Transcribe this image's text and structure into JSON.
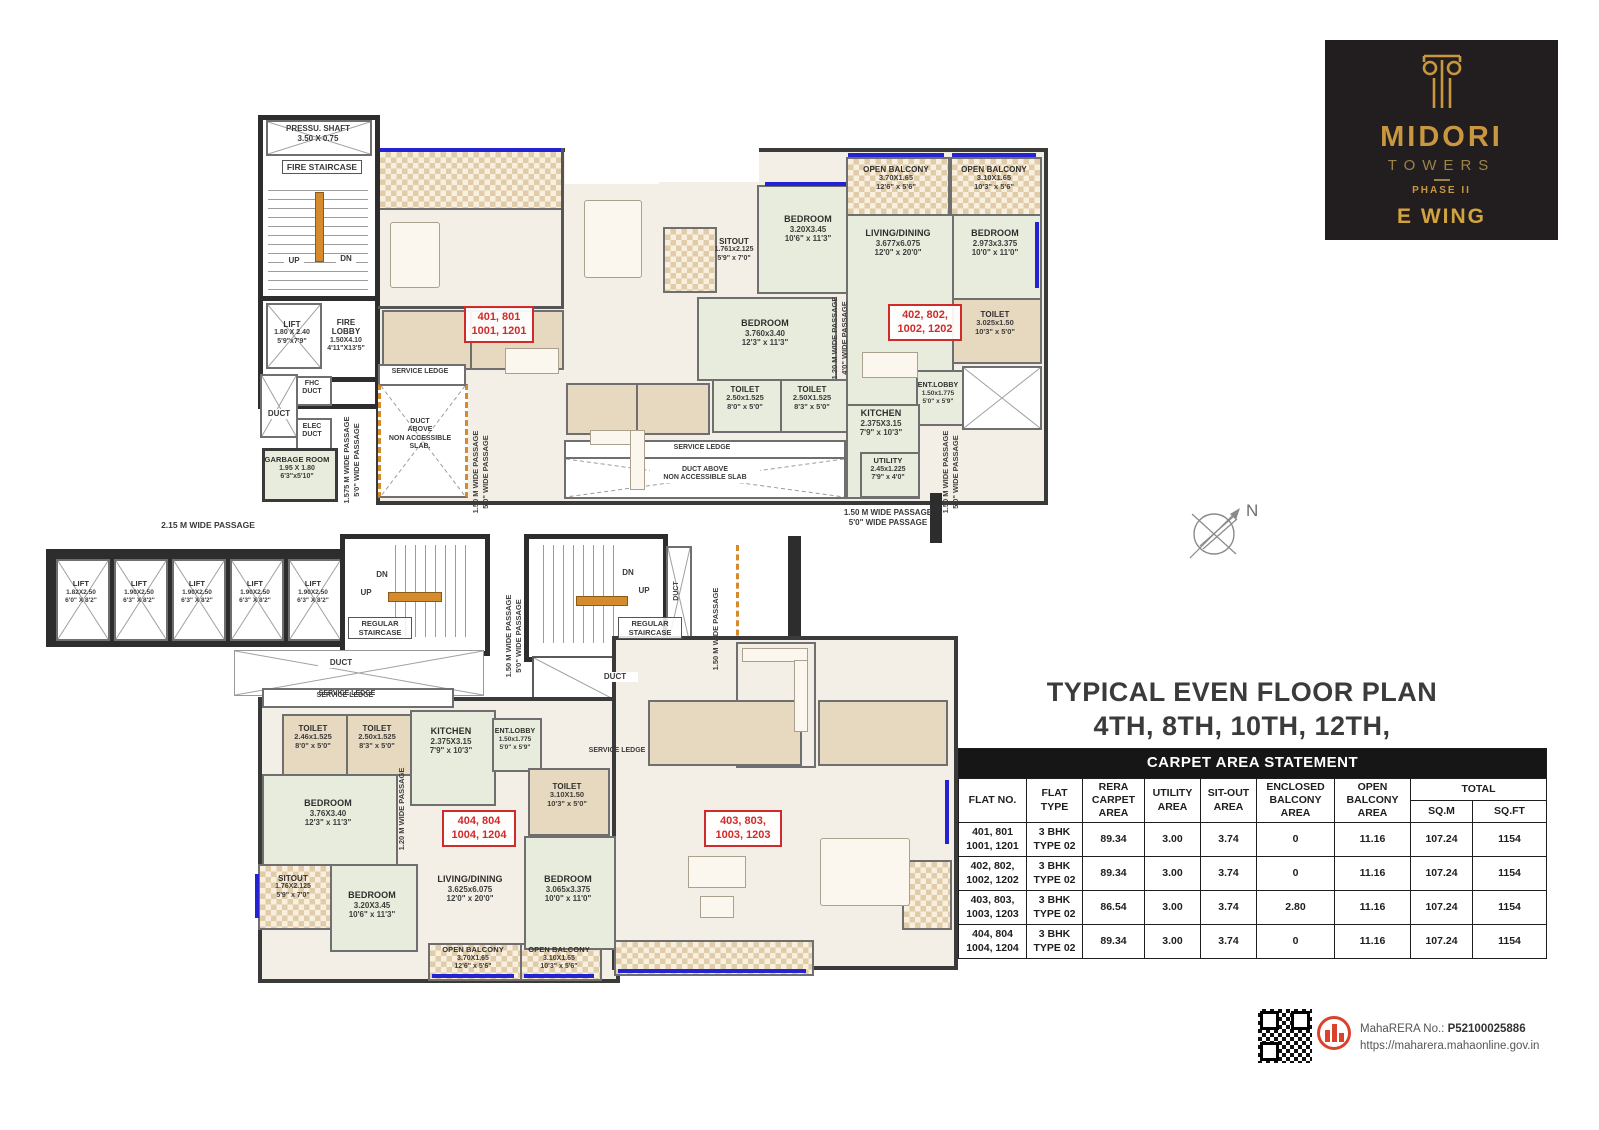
{
  "logo": {
    "brand": "MIDORI",
    "sub": "TOWERS",
    "phase": "PHASE II",
    "wing": "E WING"
  },
  "plan_title": {
    "line1": "TYPICAL EVEN FLOOR PLAN",
    "line2": "4TH, 8TH, 10TH, 12TH, FLOOR"
  },
  "compass": {
    "label": "N"
  },
  "colors": {
    "logo_gold": "#c9973f",
    "flat_number_red": "#cf2b2b",
    "rera_red": "#d9422b",
    "window_blue": "#2323d4",
    "stair_rail_orange": "#d68a2e"
  },
  "table": {
    "title": "CARPET AREA STATEMENT",
    "headers": {
      "flat_no": "FLAT NO.",
      "flat_type": "FLAT TYPE",
      "rera": "RERA CARPET AREA",
      "utility": "UTILITY AREA",
      "sitout": "SIT-OUT AREA",
      "enclosed": "ENCLOSED BALCONY AREA",
      "open": "OPEN BALCONY AREA",
      "total": "TOTAL",
      "sqm": "SQ.M",
      "sqft": "SQ.FT"
    },
    "rows": [
      {
        "no1": "401, 801",
        "no2": "1001, 1201",
        "type1": "3 BHK",
        "type2": "TYPE 02",
        "rera": "89.34",
        "utility": "3.00",
        "sitout": "3.74",
        "enclosed": "0",
        "open": "11.16",
        "sqm": "107.24",
        "sqft": "1154"
      },
      {
        "no1": "402, 802,",
        "no2": "1002, 1202",
        "type1": "3 BHK",
        "type2": "TYPE 02",
        "rera": "89.34",
        "utility": "3.00",
        "sitout": "3.74",
        "enclosed": "0",
        "open": "11.16",
        "sqm": "107.24",
        "sqft": "1154"
      },
      {
        "no1": "403, 803,",
        "no2": "1003, 1203",
        "type1": "3 BHK",
        "type2": "TYPE 02",
        "rera": "86.54",
        "utility": "3.00",
        "sitout": "3.74",
        "enclosed": "2.80",
        "open": "11.16",
        "sqm": "107.24",
        "sqft": "1154"
      },
      {
        "no1": "404, 804",
        "no2": "1004, 1204",
        "type1": "3 BHK",
        "type2": "TYPE 02",
        "rera": "89.34",
        "utility": "3.00",
        "sitout": "3.74",
        "enclosed": "0",
        "open": "11.16",
        "sqm": "107.24",
        "sqft": "1154"
      }
    ]
  },
  "footer": {
    "rera_label": "MahaRERA No.: ",
    "rera_no": "P52100025886",
    "rera_url": "https://maharera.mahaonline.gov.in"
  },
  "plan": {
    "texts": {
      "pressu_l1": "PRESSU. SHAFT",
      "pressu_l2": "3.50 X 0.75",
      "fire_staircase": "FIRE STAIRCASE",
      "up": "UP",
      "dn": "DN",
      "duct": "DUCT",
      "fhc_l1": "FHC",
      "fhc_l2": "DUCT",
      "elec_l1": "ELEC",
      "elec_l2": "DUCT",
      "service_ledge": "SERVICE LEDGE",
      "duct_above_l1": "DUCT",
      "duct_above_l2": "ABOVE",
      "duct_above_l3": "NON ACCESSIBLE",
      "duct_above_l4": "SLAB.",
      "duct_above_b1": "DUCT ABOVE",
      "duct_above_b2": "NON ACCESSIBLE SLAB",
      "passage_215": "2.15 M WIDE PASSAGE",
      "passage_1575_l1": "1.575 M WIDE PASSAGE",
      "passage_1575_l2": "5'0\" WIDE PASSAGE",
      "passage_150_l1": "1.50 M WIDE PASSAGE",
      "passage_150_l2": "5'0\" WIDE PASSAGE",
      "passage_120_l1": "1.20 M WIDE PASSAGE",
      "passage_120_l2": "4'0\" WIDE PASSAGE",
      "regular_staircase_l1": "REGULAR",
      "regular_staircase_l2": "STAIRCASE"
    },
    "rooms": {
      "lift_main": {
        "n": "LIFT",
        "m": "1.80 X 2.40",
        "i": "5'9\"x7'9\""
      },
      "fire_lobby": {
        "n": "FIRE LOBBY",
        "m": "1.50X4.10",
        "i": "4'11\"X13'5\""
      },
      "garbage": {
        "n": "GARBAGE ROOM",
        "m": "1.95 X 1.80",
        "i": "6'3\"x5'10\""
      },
      "sitout401": {
        "n": "SITOUT",
        "m": "1.761x2.125",
        "i": "5'9\" x 7'0\""
      },
      "bed401a": {
        "n": "BEDROOM",
        "m": "3.20X3.45",
        "i": "10'6\" x 11'3\""
      },
      "bed401b": {
        "n": "BEDROOM",
        "m": "3.760x3.40",
        "i": "12'3\" x 11'3\""
      },
      "toi401a": {
        "n": "TOILET",
        "m": "2.50x1.525",
        "i": "8'0\" x 5'0\""
      },
      "toi401b": {
        "n": "TOILET",
        "m": "2.50X1.525",
        "i": "8'3\" x 5'0\""
      },
      "balc402a": {
        "n": "OPEN BALCONY",
        "m": "3.70X1.65",
        "i": "12'6\" x 5'6\""
      },
      "balc402b": {
        "n": "OPEN BALCONY",
        "m": "3.10X1.65",
        "i": "10'3\" x 5'6\""
      },
      "living402": {
        "n": "LIVING/DINING",
        "m": "3.677x6.075",
        "i": "12'0\" x 20'0\""
      },
      "bed402": {
        "n": "BEDROOM",
        "m": "2.973x3.375",
        "i": "10'0\" x 11'0\""
      },
      "toi402": {
        "n": "TOILET",
        "m": "3.025x1.50",
        "i": "10'3\" x 5'0\""
      },
      "kitchen402": {
        "n": "KITCHEN",
        "m": "2.375X3.15",
        "i": "7'9\" x 10'3\""
      },
      "entlobby402": {
        "n": "ENT.LOBBY",
        "m": "1.50x1.775",
        "i": "5'0\" x 5'9\""
      },
      "utility402": {
        "n": "UTILITY",
        "m": "2.45x1.225",
        "i": "7'9\" x 4'0\""
      },
      "lift_small": {
        "n": "LIFT",
        "m": "1.82X2.50",
        "i": "6'0\" X 8'2\""
      },
      "lift_std": {
        "n": "LIFT",
        "m": "1.90X2.50",
        "i": "6'3\" X 8'2\""
      },
      "utility404": {
        "n": "UTILITY",
        "m": "2.45x1.225",
        "i": "7'9\" x 4'0\""
      },
      "toi404a": {
        "n": "TOILET",
        "m": "2.46x1.525",
        "i": "8'0\" x 5'0\""
      },
      "toi404b": {
        "n": "TOILET",
        "m": "2.50x1.525",
        "i": "8'3\" x 5'0\""
      },
      "kitchen404": {
        "n": "KITCHEN",
        "m": "2.375X3.15",
        "i": "7'9\" x 10'3\""
      },
      "entlobby404": {
        "n": "ENT.LOBBY",
        "m": "1.50x1.775",
        "i": "5'0\" x 5'9\""
      },
      "bed404a": {
        "n": "BEDROOM",
        "m": "3.76X3.40",
        "i": "12'3\" x 11'3\""
      },
      "sitout404": {
        "n": "SITOUT",
        "m": "1.76X2.125",
        "i": "5'9\" x 7'0\""
      },
      "bed404b": {
        "n": "BEDROOM",
        "m": "3.20X3.45",
        "i": "10'6\" x 11'3\""
      },
      "living404": {
        "n": "LIVING/DINING",
        "m": "3.625x6.075",
        "i": "12'0\" x 20'0\""
      },
      "toi403": {
        "n": "TOILET",
        "m": "3.10X1.50",
        "i": "10'3\" x 5'0\""
      },
      "bed403": {
        "n": "BEDROOM",
        "m": "3.065x3.375",
        "i": "10'0\" x 11'0\""
      },
      "balc404a": {
        "n": "OPEN BALCONY",
        "m": "3.70X1.65",
        "i": "12'6\" x 5'6\""
      },
      "balc404b": {
        "n": "OPEN BALCONY",
        "m": "3.10X1.65",
        "i": "10'3\" x 5'6\""
      }
    },
    "flats": {
      "f401_l1": "401, 801",
      "f401_l2": "1001, 1201",
      "f402_l1": "402, 802,",
      "f402_l2": "1002, 1202",
      "f403_l1": "403, 803,",
      "f403_l2": "1003, 1203",
      "f404_l1": "404, 804",
      "f404_l2": "1004, 1204"
    }
  }
}
